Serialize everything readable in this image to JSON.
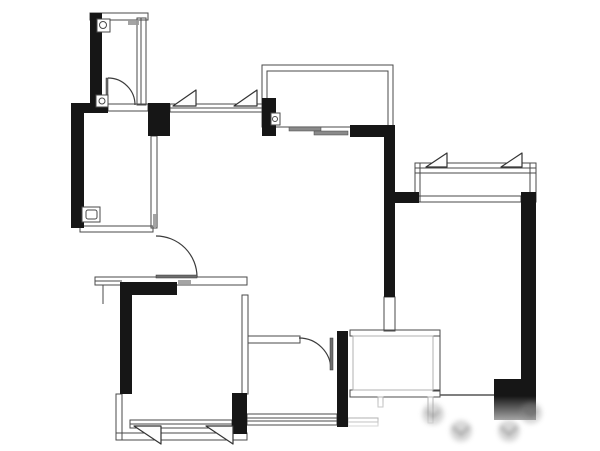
{
  "meta": {
    "title": "apartment-floor-plan",
    "canvas_width": 600,
    "canvas_height": 451
  },
  "colors": {
    "background": "#ffffff",
    "wall": "#161616",
    "line": "#4a4a4a",
    "light_line": "#b0b0b0",
    "leaf": "#6e6e6e",
    "slider": "#8a8a8a",
    "chip": "#9a9a9a",
    "watermark": "#8a8a8a"
  },
  "plan": {
    "black_walls": [
      [
        90,
        13,
        12,
        92
      ],
      [
        71,
        103,
        37,
        10
      ],
      [
        71,
        112,
        13,
        116
      ],
      [
        148,
        103,
        22,
        33
      ],
      [
        262,
        98,
        14,
        38
      ],
      [
        350,
        125,
        45,
        12
      ],
      [
        384,
        130,
        11,
        167
      ],
      [
        395,
        192,
        24,
        11
      ],
      [
        521,
        192,
        15,
        196
      ],
      [
        494,
        379,
        42,
        41
      ],
      [
        122,
        282,
        55,
        13
      ],
      [
        120,
        282,
        12,
        112
      ],
      [
        232,
        393,
        15,
        41
      ],
      [
        337,
        331,
        11,
        96
      ]
    ],
    "thin_rects": [
      [
        90,
        13,
        58,
        7
      ],
      [
        137,
        18,
        9,
        87
      ],
      [
        108,
        104,
        40,
        7
      ],
      [
        80,
        226,
        73,
        6
      ],
      [
        151,
        136,
        6,
        92
      ],
      [
        95,
        277,
        152,
        8
      ],
      [
        242,
        295,
        6,
        99
      ],
      [
        116,
        394,
        6,
        46
      ],
      [
        116,
        433,
        131,
        7
      ],
      [
        248,
        336,
        52,
        7
      ],
      [
        384,
        297,
        11,
        34
      ],
      [
        350,
        330,
        90,
        6
      ],
      [
        433,
        336,
        7,
        55
      ],
      [
        350,
        390,
        90,
        7
      ],
      [
        415,
        163,
        121,
        39
      ],
      [
        417,
        196,
        104,
        6
      ],
      [
        262,
        65,
        131,
        62
      ],
      [
        267,
        71,
        121,
        56
      ],
      [
        170,
        104,
        92,
        8
      ],
      [
        130,
        420,
        102,
        8
      ],
      [
        247,
        414,
        90,
        11
      ],
      [
        348,
        418,
        30,
        8
      ]
    ],
    "lines": [
      [
        141,
        18,
        141,
        105
      ],
      [
        170,
        108,
        262,
        108
      ],
      [
        130,
        424,
        232,
        424
      ],
      [
        247,
        418,
        337,
        418
      ],
      [
        247,
        421,
        337,
        421
      ],
      [
        348,
        422,
        378,
        422
      ],
      [
        415,
        168,
        536,
        168
      ],
      [
        415,
        173,
        536,
        173
      ],
      [
        420,
        163,
        420,
        202
      ],
      [
        530,
        163,
        530,
        202
      ],
      [
        95,
        281,
        122,
        281
      ],
      [
        103,
        285,
        103,
        304
      ],
      [
        192,
        285,
        247,
        285
      ]
    ],
    "dark_lines": [
      [
        440,
        395,
        494,
        395
      ]
    ],
    "light_rects": [
      [
        353,
        336,
        80,
        54
      ],
      [
        378,
        397,
        5,
        10
      ],
      [
        428,
        397,
        5,
        26
      ]
    ],
    "doors": [
      {
        "leaf": [
          106,
          78,
          2,
          27
        ],
        "arc": "M 135,105 A 27,27 0 0 0 108,78"
      },
      {
        "leaf": [
          156,
          275,
          41,
          3
        ],
        "arc": "M 156,236 A 41,41 0 0 1 197,277"
      },
      {
        "leaf": [
          330,
          338,
          3,
          32
        ],
        "arc": "M 299,338 A 32,32 0 0 1 331,370"
      }
    ],
    "casements": [
      "173,106 196,90 196,106",
      "234,106 257,90 257,106",
      "426,167 447,153 447,167",
      "501,167 522,153 522,167",
      "134,426 161,444 161,426",
      "206,426 233,444 233,426"
    ],
    "slider_bars": [
      [
        289,
        127,
        32,
        4
      ],
      [
        314,
        131,
        34,
        4
      ]
    ],
    "drains": [
      {
        "rect": [
          97,
          19,
          13,
          13
        ],
        "circle": [
          103,
          25,
          3.5
        ]
      },
      {
        "rect": [
          96,
          95,
          12,
          12
        ],
        "circle": [
          102,
          101,
          3
        ]
      },
      {
        "rect": [
          271,
          113,
          9,
          12
        ],
        "circle": [
          275,
          119,
          2.5
        ]
      },
      {
        "rect": [
          82,
          207,
          18,
          15
        ],
        "inner": [
          86,
          210,
          11,
          9
        ]
      }
    ],
    "chips": [
      [
        128,
        20,
        11,
        5
      ],
      [
        178,
        280,
        13,
        5
      ],
      [
        153,
        214,
        5,
        13
      ]
    ],
    "fade": {
      "x": 348,
      "y": 396,
      "w": 252,
      "h": 55
    },
    "watermark": {
      "blobs": [
        [
          433,
          414,
          11
        ],
        [
          461,
          431,
          11
        ],
        [
          509,
          431,
          11
        ],
        [
          531,
          413,
          11
        ]
      ],
      "chevrons": [
        "M 427,411 l 6,6 l 6,-6",
        "M 453,427 l 8,8 l 8,-8",
        "M 501,427 l 8,8 l 8,-8",
        "M 525,410 l 6,6 l 6,-6"
      ]
    }
  }
}
